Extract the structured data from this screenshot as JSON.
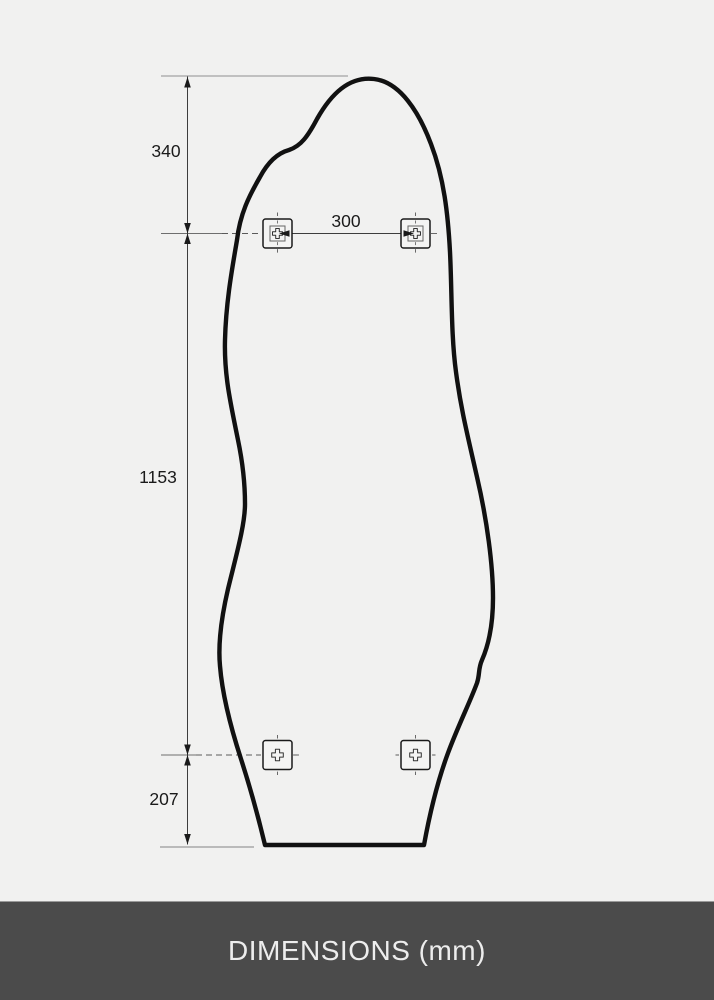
{
  "diagram": {
    "dimensions": {
      "top_offset": "340",
      "bracket_spacing": "300",
      "middle_span": "1153",
      "bottom_offset": "207"
    },
    "unit_note": "mm"
  },
  "footer": {
    "label": "DIMENSIONS (mm)"
  },
  "colors": {
    "background": "#f1f1f0",
    "shape_outline": "#111111",
    "dimension_line": "#3d3d3d",
    "extension_line": "#8f8f8f",
    "footer_background": "#4b4b4b",
    "footer_text": "#ededed"
  }
}
